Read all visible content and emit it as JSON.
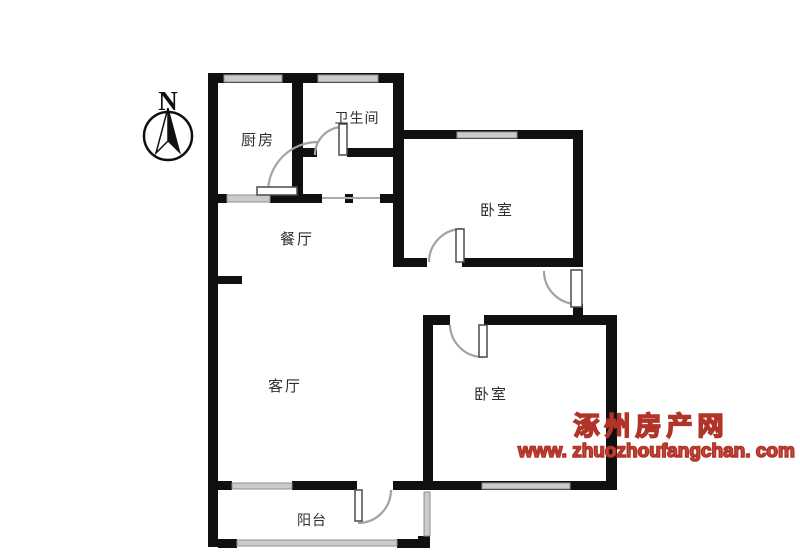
{
  "compass": {
    "label": "N"
  },
  "rooms": {
    "kitchen": {
      "label": "厨房"
    },
    "bathroom": {
      "label": "卫生间"
    },
    "bedroom_north": {
      "label": "卧室"
    },
    "dining": {
      "label": "餐厅"
    },
    "living": {
      "label": "客厅"
    },
    "bedroom_south": {
      "label": "卧室"
    },
    "balcony": {
      "label": "阳台"
    }
  },
  "watermark": {
    "site_name": "涿州房产网",
    "site_url": "www. zhuozhoufangchan. com"
  },
  "palette": {
    "wall": "#101010",
    "window_fill": "#cbcbcb",
    "window_edge": "#8f8f8f",
    "door_arc": "#a3a3a3",
    "label_color": "#2e2e2e",
    "watermark_red": "#bf3a30"
  }
}
